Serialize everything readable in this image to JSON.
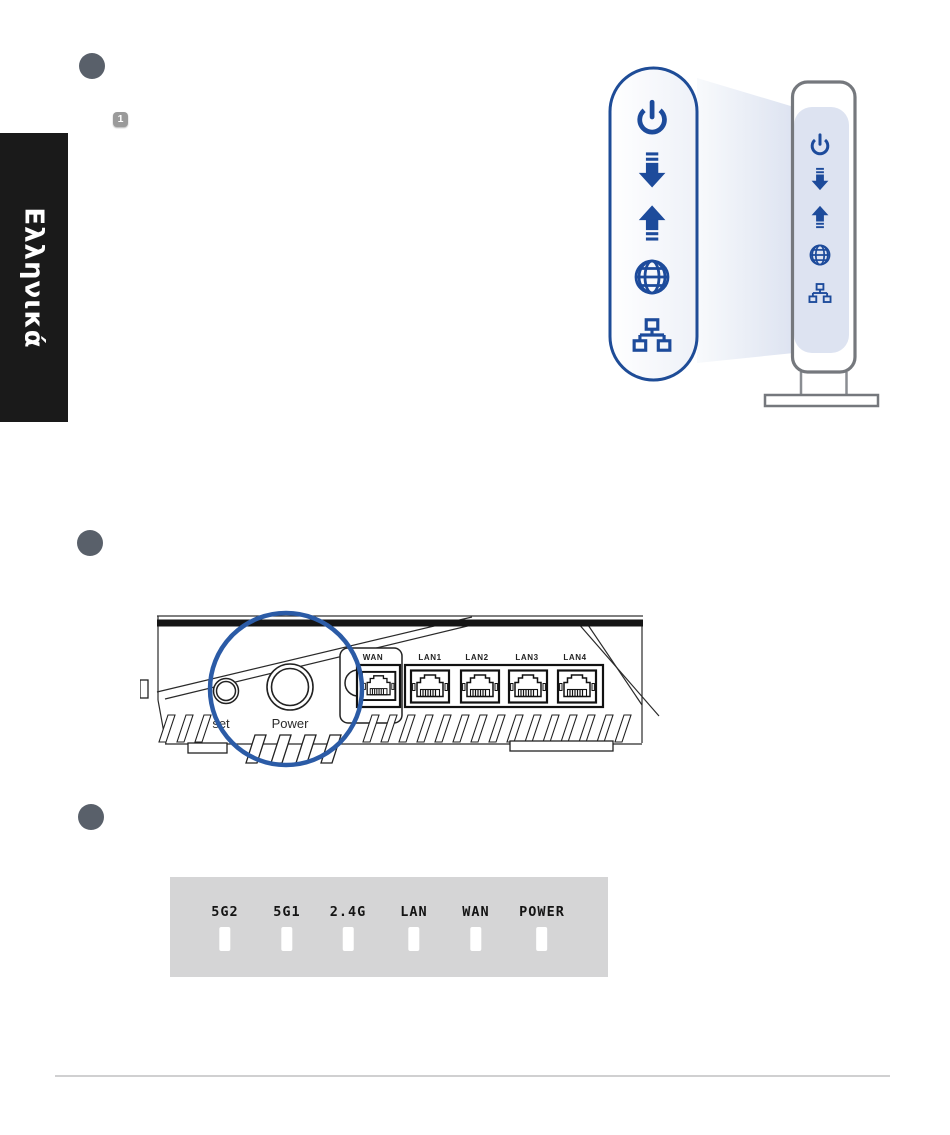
{
  "page": {
    "language_tab_label": "Ελληνικά",
    "step_badge_1": "1"
  },
  "modem_illustration": {
    "status_icons": [
      "power-icon",
      "downlink-icon",
      "uplink-icon",
      "internet-globe-icon",
      "lan-network-icon"
    ],
    "accent_blue": "#1d4b9b",
    "callout_border_blue": "#1e4c97",
    "beam_blue": "#dde3f1",
    "modem_outline_gray": "#75787d"
  },
  "router_rear_illustration": {
    "port_labels": [
      "WAN",
      "LAN1",
      "LAN2",
      "LAN3",
      "LAN4"
    ],
    "reset_button_label_visible": "set",
    "power_button_label": "Power",
    "magnifier_outline": "#2b5ba6"
  },
  "led_panel": {
    "labels": [
      "5G2",
      "5G1",
      "2.4G",
      "LAN",
      "WAN",
      "POWER"
    ],
    "background": "#d5d5d6",
    "slot_color": "#ffffff"
  },
  "colors": {
    "step_circle": "#59606a",
    "tab_background": "#1a1a1a",
    "divider": "#d0d0d1"
  }
}
